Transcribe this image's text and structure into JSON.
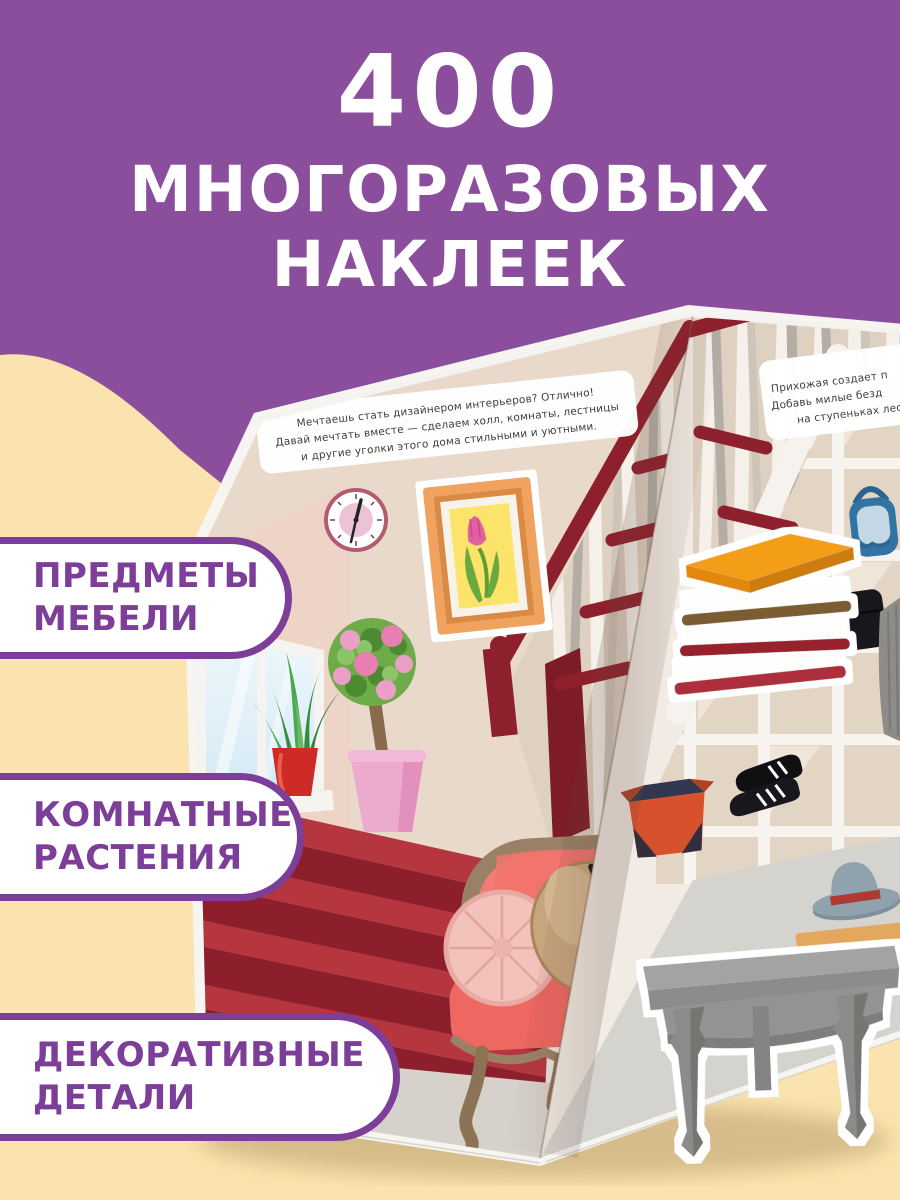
{
  "title": {
    "line1": "400",
    "line2": "МНОГОРАЗОВЫХ",
    "line3": "НАКЛЕЕК"
  },
  "badges": [
    {
      "line1": "ПРЕДМЕТЫ",
      "line2": "МЕБЕЛИ"
    },
    {
      "line1": "КОМНАТНЫЕ",
      "line2": "РАСТЕНИЯ"
    },
    {
      "line1": "ДЕКОРАТИВНЫЕ",
      "line2": "ДЕТАЛИ"
    }
  ],
  "book": {
    "left_note": {
      "line1": "Мечтаешь стать дизайнером интерьеров? Отлично!",
      "line2": "Давай мечтать вместе — сделаем холл, комнаты, лестницы",
      "line3": "и другие уголки этого дома стильными и уютными."
    },
    "right_note": {
      "line1": "Прихожая создает п",
      "line2": "Добавь милые безд",
      "line3": "на ступеньках лес"
    }
  },
  "colors": {
    "background_purple": "#8B4E9D",
    "cream": "#FAE3AE",
    "badge_purple": "#7C3E98",
    "title_white": "#FFFFFF",
    "stair_red": "#8E1F2C",
    "armchair_coral": "#EC5F5C",
    "book_cover_orange": "#F49D17"
  }
}
